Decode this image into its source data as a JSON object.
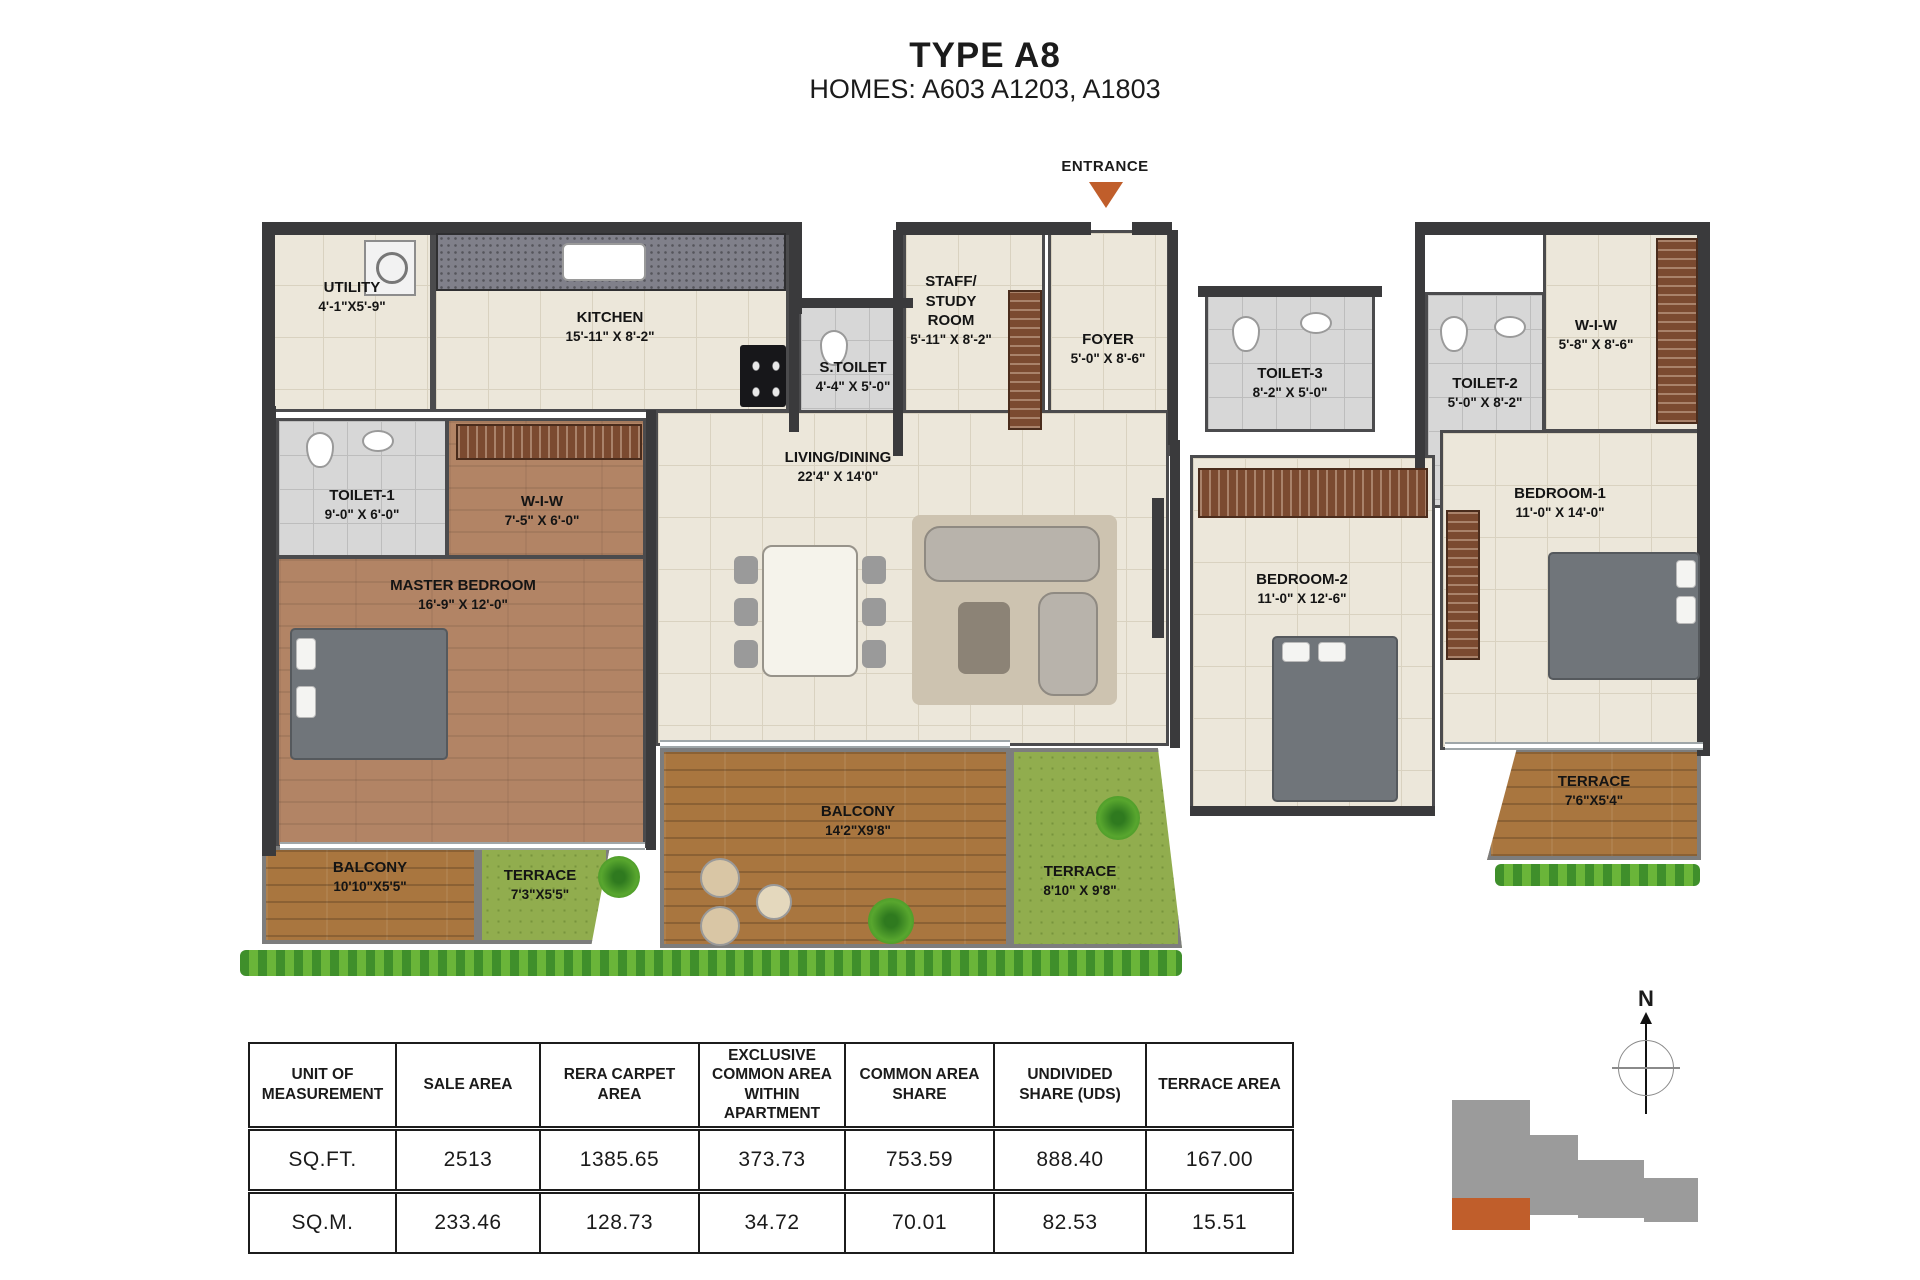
{
  "header": {
    "title": "TYPE A8",
    "subtitle": "HOMES: A603 A1203, A1803"
  },
  "entrance": {
    "label": "ENTRANCE"
  },
  "compass": {
    "label": "N"
  },
  "colors": {
    "accent_orange": "#c05e2b",
    "wall_dark": "#3a3a3c",
    "floor_beige": "#ece7da",
    "floor_gray": "#d7d7d7",
    "wood_brown": "#b28465",
    "balcony_plank": "#a9763f",
    "grass_green": "#91ad4e",
    "hedge_green": "#4f9c2e"
  },
  "rooms": {
    "utility": {
      "name": "UTILITY",
      "dim": "4'-1\"X5'-9\""
    },
    "kitchen": {
      "name": "KITCHEN",
      "dim": "15'-11\" X 8'-2\""
    },
    "stoilet": {
      "name": "S.TOILET",
      "dim": "4'-4\" X 5'-0\""
    },
    "staff": {
      "name": "STAFF/\nSTUDY\nROOM",
      "dim": "5'-11\" X 8'-2\""
    },
    "foyer": {
      "name": "FOYER",
      "dim": "5'-0\" X 8'-6\""
    },
    "toilet3": {
      "name": "TOILET-3",
      "dim": "8'-2\" X 5'-0\""
    },
    "toilet2": {
      "name": "TOILET-2",
      "dim": "5'-0\" X 8'-2\""
    },
    "wiw_right": {
      "name": "W-I-W",
      "dim": "5'-8\" X 8'-6\""
    },
    "living": {
      "name": "LIVING/DINING",
      "dim": "22'4\" X 14'0\""
    },
    "toilet1": {
      "name": "TOILET-1",
      "dim": "9'-0\" X 6'-0\""
    },
    "wiw_left": {
      "name": "W-I-W",
      "dim": "7'-5\" X 6'-0\""
    },
    "master": {
      "name": "MASTER BEDROOM",
      "dim": "16'-9\" X 12'-0\""
    },
    "bedroom2": {
      "name": "BEDROOM-2",
      "dim": "11'-0\" X 12'-6\""
    },
    "bedroom1": {
      "name": "BEDROOM-1",
      "dim": "11'-0\" X 14'-0\""
    },
    "balcony_left": {
      "name": "BALCONY",
      "dim": "10'10\"X5'5\""
    },
    "terrace_left": {
      "name": "TERRACE",
      "dim": "7'3\"X5'5\""
    },
    "balcony_center": {
      "name": "BALCONY",
      "dim": "14'2\"X9'8\""
    },
    "terrace_center": {
      "name": "TERRACE",
      "dim": "8'10\" X 9'8\""
    },
    "terrace_right": {
      "name": "TERRACE",
      "dim": "7'6\"X5'4\""
    }
  },
  "table": {
    "headers": [
      "UNIT OF MEASUREMENT",
      "SALE AREA",
      "RERA CARPET AREA",
      "EXCLUSIVE COMMON AREA WITHIN APARTMENT",
      "COMMON AREA SHARE",
      "UNDIVIDED SHARE (UDS)",
      "TERRACE AREA"
    ],
    "rows": [
      {
        "unit": "SQ.FT.",
        "values": [
          "2513",
          "1385.65",
          "373.73",
          "753.59",
          "888.40",
          "167.00"
        ]
      },
      {
        "unit": "SQ.M.",
        "values": [
          "233.46",
          "128.73",
          "34.72",
          "70.01",
          "82.53",
          "15.51"
        ]
      }
    ]
  }
}
